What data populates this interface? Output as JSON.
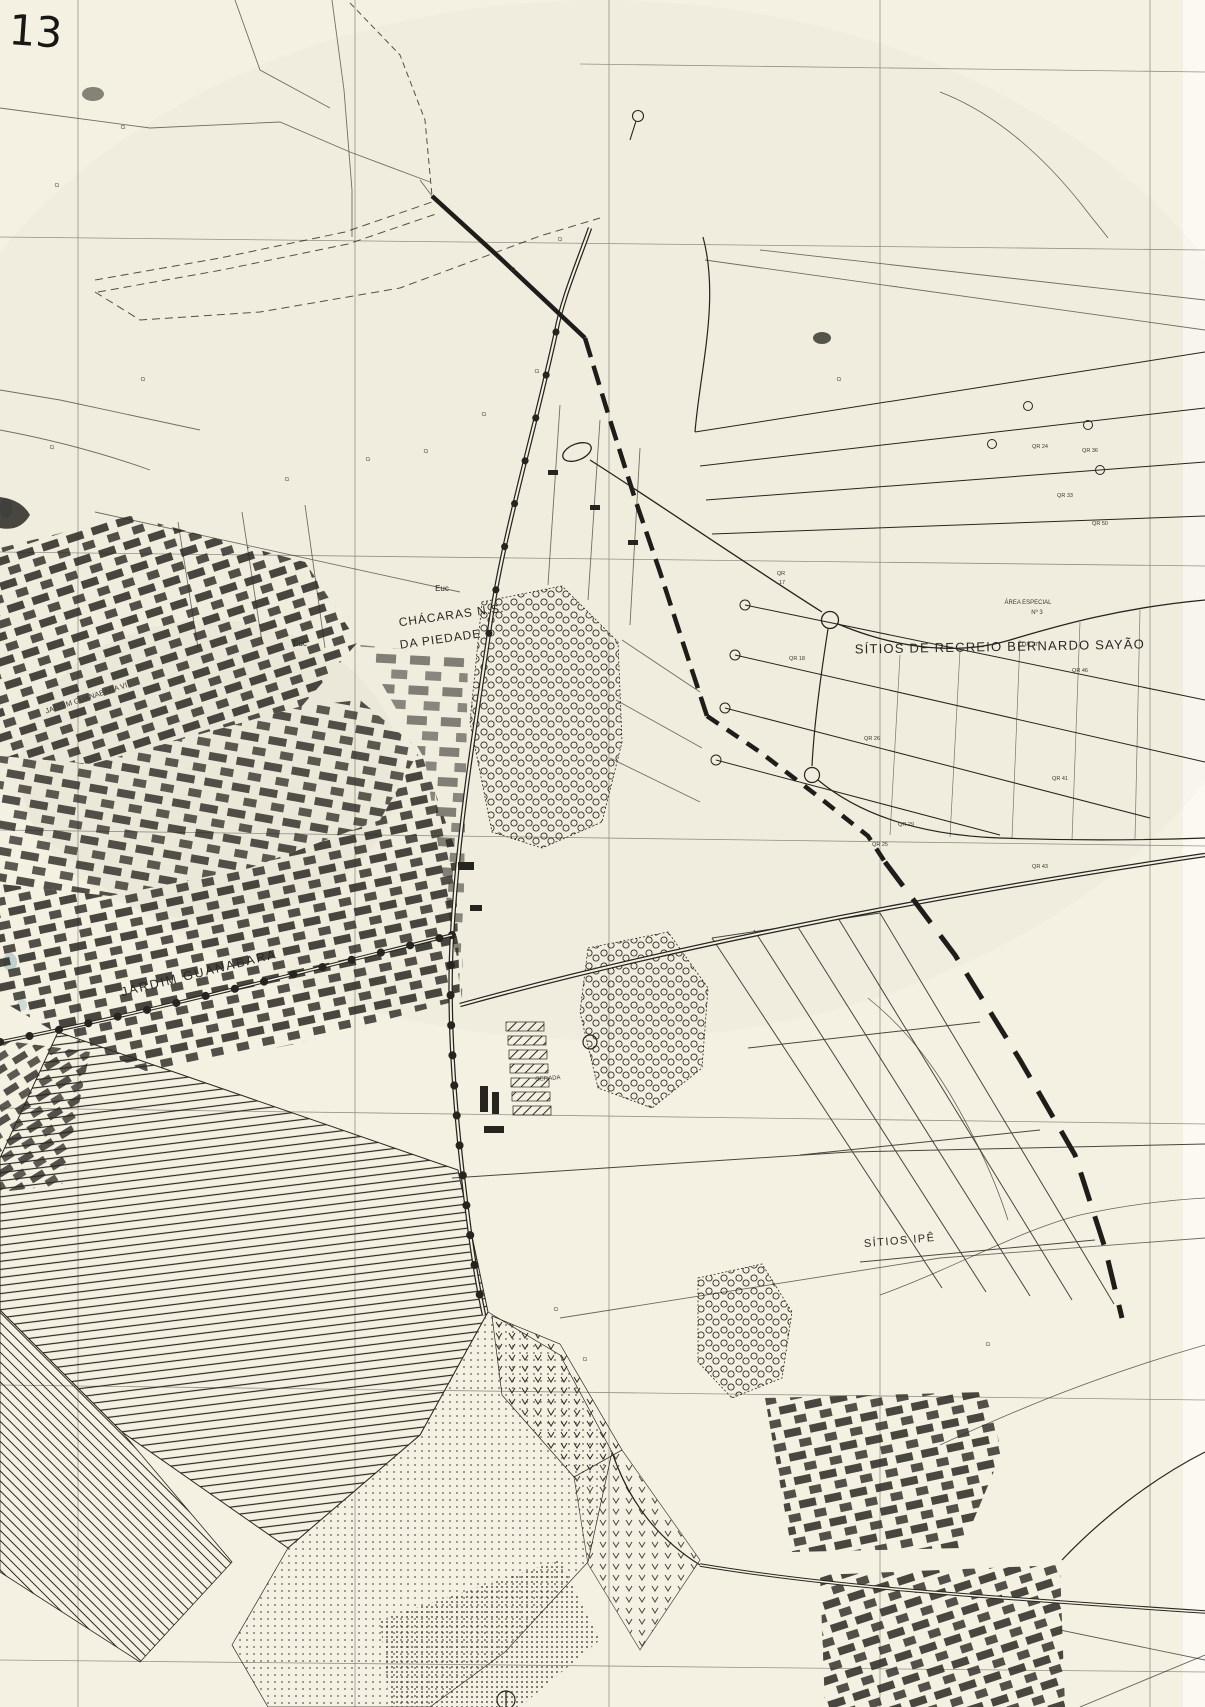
{
  "document": {
    "kind_visible_text": "scanned planimetric map sheet",
    "sheet_number": "13"
  },
  "colors": {
    "paper": "#f5f1e2",
    "paper_light": "#fbf9f2",
    "ink": "#26241f",
    "ink_faint": "#55524a",
    "smudge_blue": "#7fa8b8"
  },
  "map_labels": [
    {
      "key": "sheet-number",
      "text": "13",
      "x": 8,
      "y": 44,
      "size": 42,
      "rot": 4,
      "anchor": "start",
      "cls": "hand"
    },
    {
      "key": "euc-1",
      "text": "Euc",
      "x": 442,
      "y": 591,
      "size": 8,
      "rot": 0,
      "cls": "lbl"
    },
    {
      "key": "euc-2",
      "text": "Euc",
      "x": 300,
      "y": 646,
      "size": 8,
      "rot": 0,
      "cls": "lbl"
    },
    {
      "key": "chacaras-line1",
      "text": "CHÁCARAS  N.S.",
      "x": 452,
      "y": 619,
      "size": 12,
      "rot": -8,
      "spacing": 1,
      "cls": "lbl"
    },
    {
      "key": "chacaras-line2",
      "text": "DA PIEDADE",
      "x": 441,
      "y": 643,
      "size": 12,
      "rot": -8,
      "spacing": 1,
      "cls": "lbl"
    },
    {
      "key": "sitios-recreio-bernardo-sayao",
      "text": "SÍTIOS  DE  RECREIO  BERNARDO  SAYÃO",
      "x": 1000,
      "y": 651,
      "size": 13,
      "rot": -1,
      "spacing": 1.2,
      "cls": "lbl"
    },
    {
      "key": "area-especial-line1",
      "text": "ÁREA  ESPECIAL",
      "x": 1028,
      "y": 604,
      "size": 6,
      "rot": 0,
      "cls": "tiny"
    },
    {
      "key": "area-especial-line2",
      "text": "Nº 3",
      "x": 1037,
      "y": 614,
      "size": 6,
      "rot": 0,
      "cls": "tiny"
    },
    {
      "key": "jardim-guanabara",
      "text": "JARDIM    GUANABARA",
      "x": 200,
      "y": 977,
      "size": 12.5,
      "rot": -14,
      "spacing": 2,
      "cls": "lbl"
    },
    {
      "key": "jardim-guanabara-vii",
      "text": "JARDIM GUANABARA VII",
      "x": 88,
      "y": 700,
      "size": 7.5,
      "rot": -18,
      "cls": "tiny"
    },
    {
      "key": "sitios-ipe",
      "text": "SÍTIOS  IPÊ",
      "x": 900,
      "y": 1244,
      "size": 11,
      "rot": -5,
      "spacing": 1.5,
      "cls": "lbl"
    },
    {
      "key": "gerada",
      "text": "GERADA",
      "x": 548,
      "y": 1080,
      "size": 6,
      "rot": -4,
      "cls": "tiny"
    },
    {
      "key": "qr-17-line1",
      "text": "QR",
      "x": 781,
      "y": 575,
      "size": 5.5,
      "rot": 0,
      "cls": "tiny"
    },
    {
      "key": "qr-17-line2",
      "text": "17",
      "x": 782,
      "y": 584,
      "size": 5.5,
      "rot": 0,
      "cls": "tiny"
    },
    {
      "key": "qr-24",
      "text": "QR 24",
      "x": 1040,
      "y": 448,
      "size": 5.5,
      "rot": 0,
      "cls": "tiny"
    },
    {
      "key": "qr-36",
      "text": "QR 36",
      "x": 1090,
      "y": 452,
      "size": 5.5,
      "rot": 0,
      "cls": "tiny"
    },
    {
      "key": "qr-33",
      "text": "QR 33",
      "x": 1065,
      "y": 497,
      "size": 5.5,
      "rot": 0,
      "cls": "tiny"
    },
    {
      "key": "qr-50",
      "text": "QR 50",
      "x": 1100,
      "y": 525,
      "size": 5.5,
      "rot": 0,
      "cls": "tiny"
    },
    {
      "key": "qr-27",
      "text": "QR 27",
      "x": 1030,
      "y": 646,
      "size": 5.5,
      "rot": 0,
      "cls": "tiny"
    },
    {
      "key": "qr-46",
      "text": "QR 46",
      "x": 1080,
      "y": 672,
      "size": 5.5,
      "rot": 0,
      "cls": "tiny"
    },
    {
      "key": "qr-18",
      "text": "QR 18",
      "x": 797,
      "y": 660,
      "size": 5.5,
      "rot": 0,
      "cls": "tiny"
    },
    {
      "key": "qr-26",
      "text": "QR 26",
      "x": 872,
      "y": 740,
      "size": 5.5,
      "rot": 0,
      "cls": "tiny"
    },
    {
      "key": "qr-29",
      "text": "QR 29",
      "x": 906,
      "y": 826,
      "size": 5.5,
      "rot": 0,
      "cls": "tiny"
    },
    {
      "key": "qr-41",
      "text": "QR 41",
      "x": 1060,
      "y": 780,
      "size": 5.5,
      "rot": 0,
      "cls": "tiny"
    },
    {
      "key": "qr-25",
      "text": "QR 25",
      "x": 880,
      "y": 846,
      "size": 5.5,
      "rot": 0,
      "cls": "tiny"
    },
    {
      "key": "qr-43",
      "text": "QR 43",
      "x": 1040,
      "y": 868,
      "size": 5.5,
      "rot": 0,
      "cls": "tiny"
    },
    {
      "key": "ci-1",
      "text": "Ci",
      "x": 123,
      "y": 129,
      "size": 5,
      "rot": 0,
      "cls": "tiny"
    },
    {
      "key": "ci-2",
      "text": "Ci",
      "x": 57,
      "y": 187,
      "size": 5,
      "rot": 0,
      "cls": "tiny"
    },
    {
      "key": "ci-3",
      "text": "Ci",
      "x": 143,
      "y": 381,
      "size": 5,
      "rot": 0,
      "cls": "tiny"
    },
    {
      "key": "ci-4",
      "text": "Ci",
      "x": 52,
      "y": 449,
      "size": 5,
      "rot": 0,
      "cls": "tiny"
    },
    {
      "key": "ci-5",
      "text": "Ci",
      "x": 287,
      "y": 481,
      "size": 5,
      "rot": 0,
      "cls": "tiny"
    },
    {
      "key": "ci-6",
      "text": "Ci",
      "x": 368,
      "y": 461,
      "size": 5,
      "rot": 0,
      "cls": "tiny"
    },
    {
      "key": "ci-7",
      "text": "Ci",
      "x": 426,
      "y": 453,
      "size": 5,
      "rot": 0,
      "cls": "tiny"
    },
    {
      "key": "ci-8",
      "text": "Ci",
      "x": 484,
      "y": 416,
      "size": 5,
      "rot": 0,
      "cls": "tiny"
    },
    {
      "key": "ci-9",
      "text": "Ci",
      "x": 537,
      "y": 373,
      "size": 5,
      "rot": 0,
      "cls": "tiny"
    },
    {
      "key": "ci-10",
      "text": "Ci",
      "x": 513,
      "y": 271,
      "size": 5,
      "rot": 0,
      "cls": "tiny"
    },
    {
      "key": "ci-11",
      "text": "Ci",
      "x": 560,
      "y": 241,
      "size": 5,
      "rot": 0,
      "cls": "tiny"
    },
    {
      "key": "ci-12",
      "text": "Ci",
      "x": 839,
      "y": 381,
      "size": 5,
      "rot": 0,
      "cls": "tiny"
    },
    {
      "key": "ci-13",
      "text": "Ci",
      "x": 556,
      "y": 1311,
      "size": 5,
      "rot": 0,
      "cls": "tiny"
    },
    {
      "key": "ci-14",
      "text": "Ci",
      "x": 585,
      "y": 1361,
      "size": 5,
      "rot": 0,
      "cls": "tiny"
    },
    {
      "key": "ci-15",
      "text": "Ci",
      "x": 988,
      "y": 1346,
      "size": 5,
      "rot": 0,
      "cls": "tiny"
    }
  ]
}
